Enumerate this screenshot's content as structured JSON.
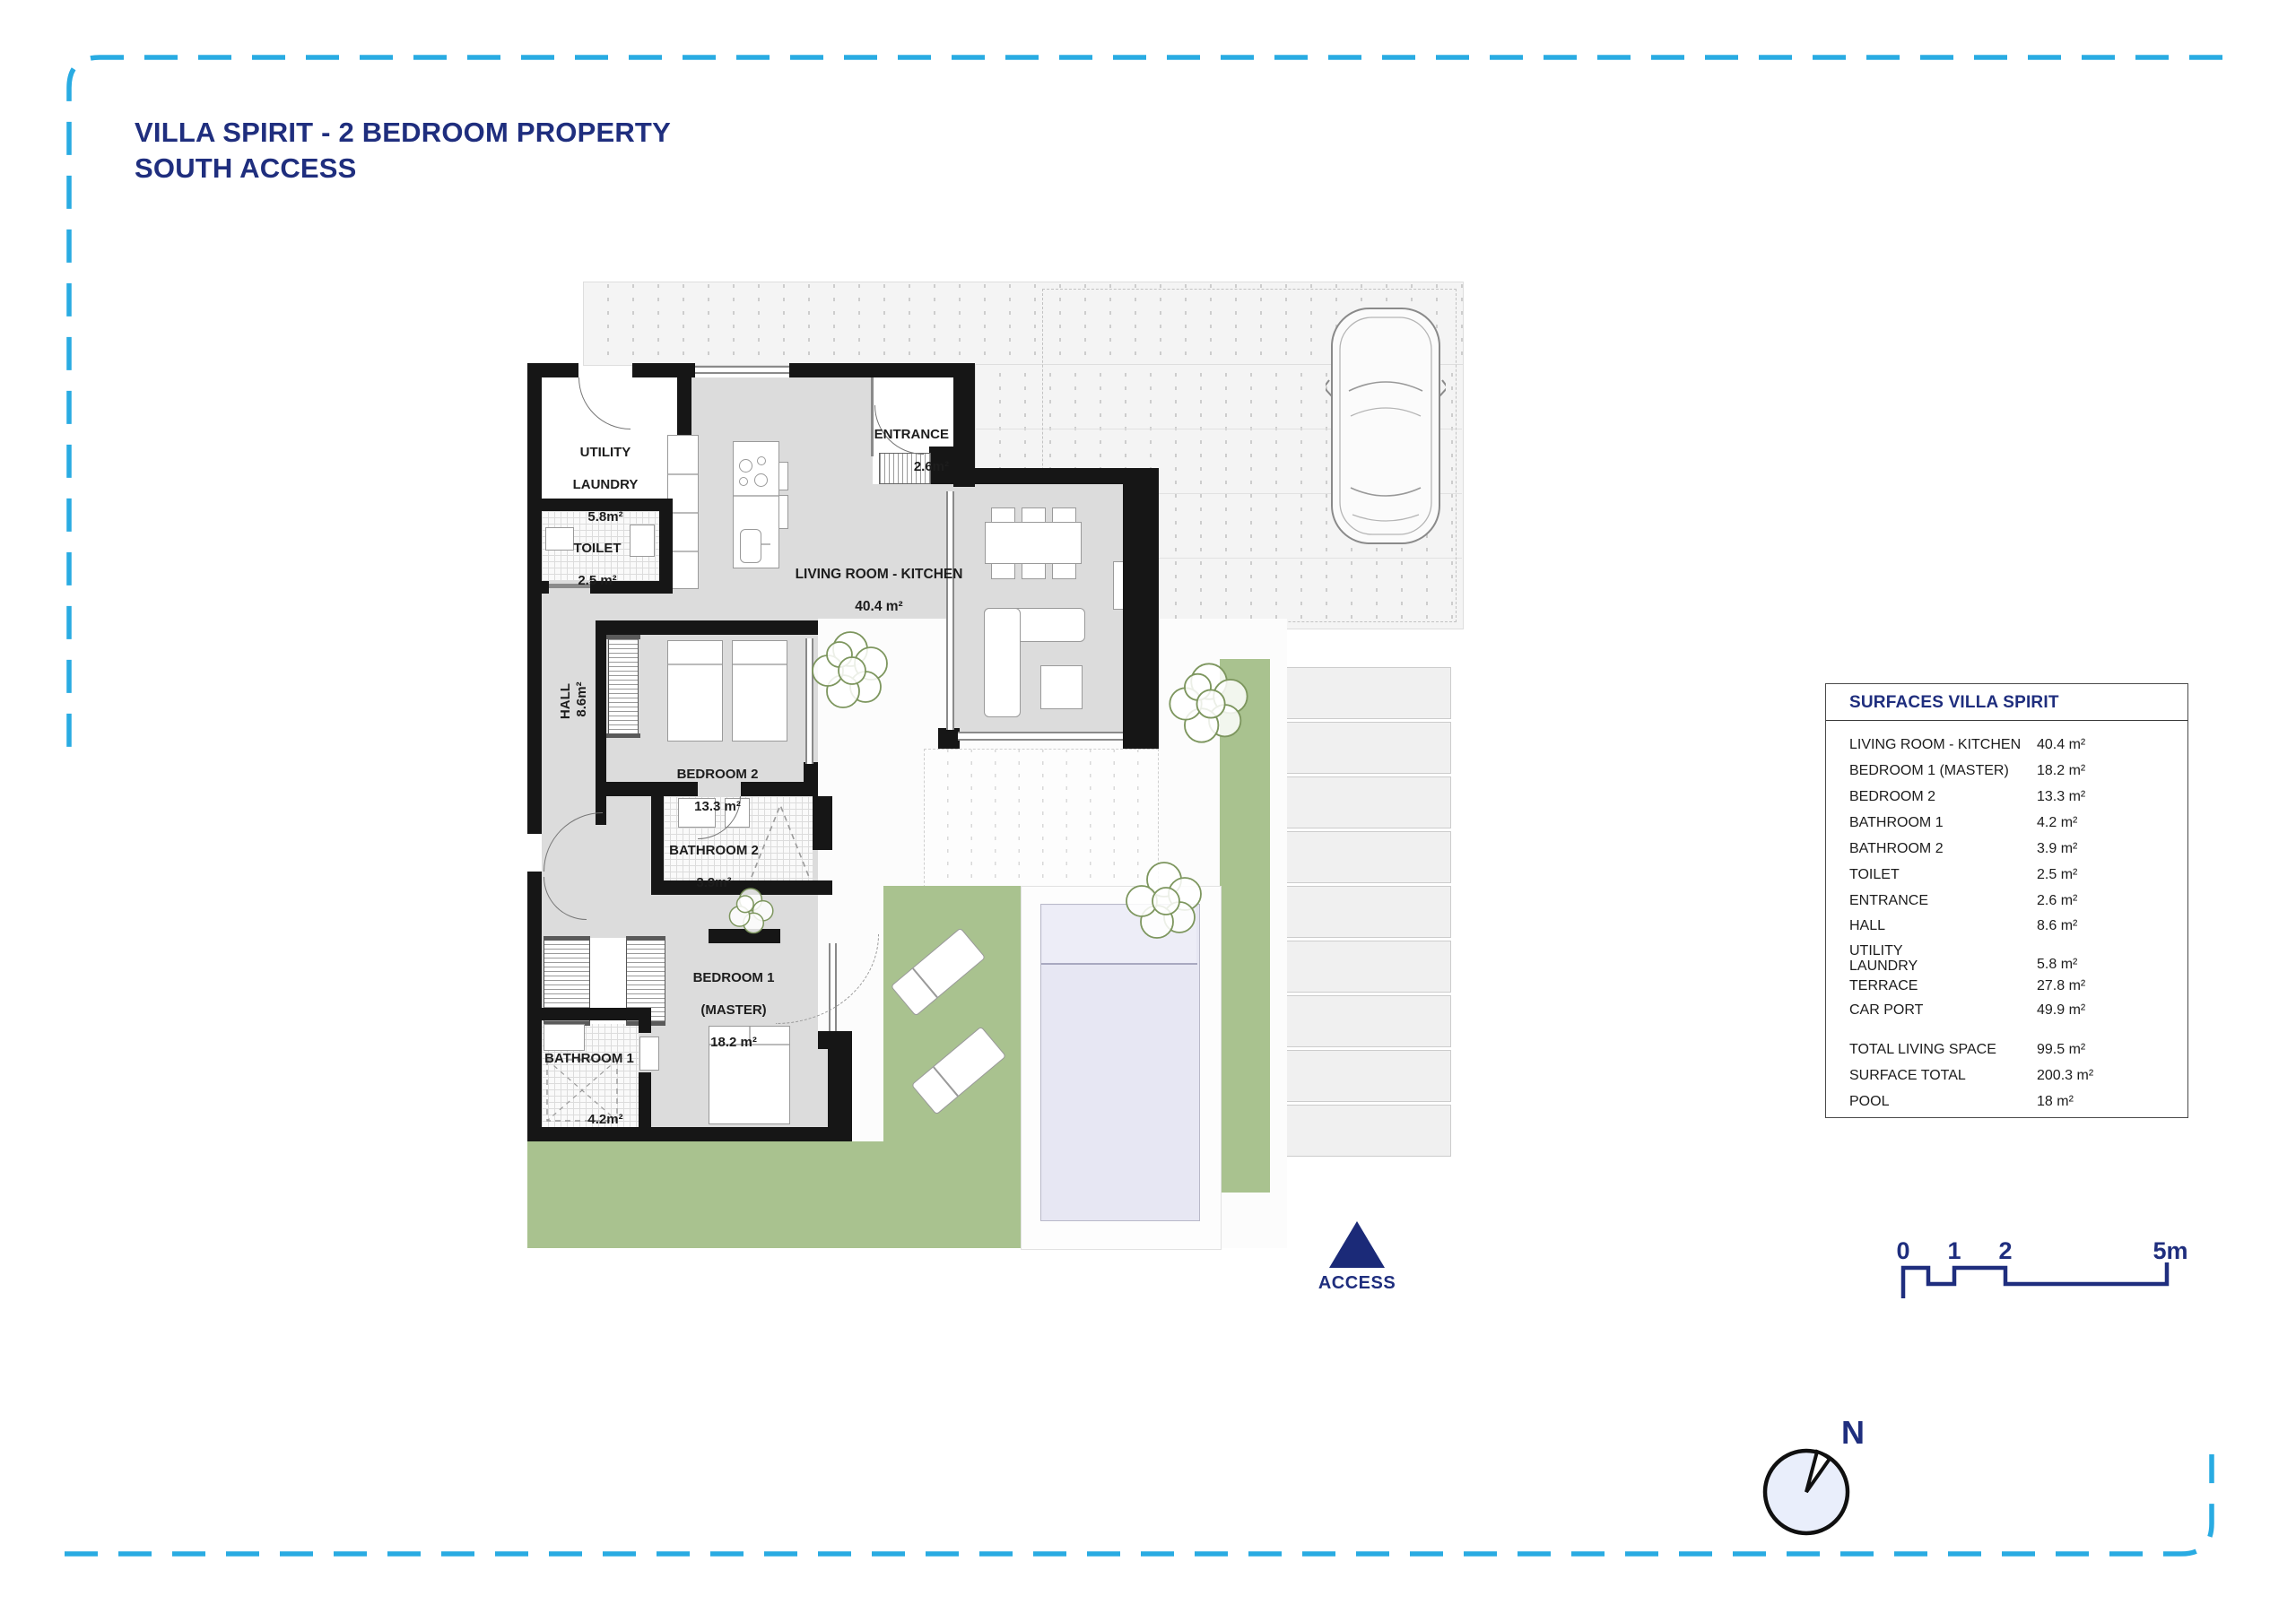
{
  "header": {
    "title_line1": "VILLA SPIRIT - 2 BEDROOM PROPERTY",
    "title_line2": "SOUTH ACCESS"
  },
  "plan": {
    "rooms": {
      "utility": {
        "name": "UTILITY",
        "name2": "LAUNDRY",
        "area": "5.8m²"
      },
      "toilet": {
        "name": "TOILET",
        "area": "2.5 m²"
      },
      "entrance": {
        "name": "ENTRANCE",
        "area": "2.6m²"
      },
      "living": {
        "name": "LIVING ROOM - KITCHEN",
        "area": "40.4 m²"
      },
      "hall": {
        "name": "HALL",
        "area": "8.6m²"
      },
      "bedroom2": {
        "name": "BEDROOM 2",
        "area": "13.3 m²"
      },
      "bathroom2": {
        "name": "BATHROOM 2",
        "area": "3.9m²"
      },
      "bedroom1": {
        "name": "BEDROOM 1",
        "name2": "(MASTER)",
        "area": "18.2 m²"
      },
      "bathroom1": {
        "name": "BATHROOM 1",
        "area": "4.2m²"
      }
    },
    "access_label": "ACCESS",
    "compass_label": "N"
  },
  "surfaces_table": {
    "title": "SURFACES VILLA SPIRIT",
    "rows": [
      {
        "label": "LIVING ROOM - KITCHEN",
        "value": "40.4 m²"
      },
      {
        "label": "BEDROOM 1 (MASTER)",
        "value": "18.2 m²"
      },
      {
        "label": "BEDROOM 2",
        "value": "13.3 m²"
      },
      {
        "label": "BATHROOM 1",
        "value": "4.2 m²"
      },
      {
        "label": "BATHROOM 2",
        "value": "3.9 m²"
      },
      {
        "label": "TOILET",
        "value": "2.5 m²"
      },
      {
        "label": "ENTRANCE",
        "value": "2.6 m²"
      },
      {
        "label": "HALL",
        "value": "8.6 m²"
      },
      {
        "label": "UTILITY\nLAUNDRY",
        "value": "5.8 m²"
      },
      {
        "label": "TERRACE",
        "value": "27.8 m²"
      },
      {
        "label": "CAR PORT",
        "value": "49.9 m²"
      }
    ],
    "totals": [
      {
        "label": "TOTAL LIVING SPACE",
        "value": "99.5 m²"
      },
      {
        "label": "SURFACE TOTAL",
        "value": "200.3 m²"
      },
      {
        "label": "POOL",
        "value": "18 m²"
      }
    ]
  },
  "scale_bar": {
    "ticks": [
      "0",
      "1",
      "2",
      "5m"
    ]
  },
  "colors": {
    "accent_navy": "#1f2e7e",
    "border_cyan": "#29abe2",
    "lawn_green": "#a9c28f",
    "pool_water": "#e7e7f3",
    "wall_black": "#161616",
    "floor_gray": "#dcdcdc"
  }
}
